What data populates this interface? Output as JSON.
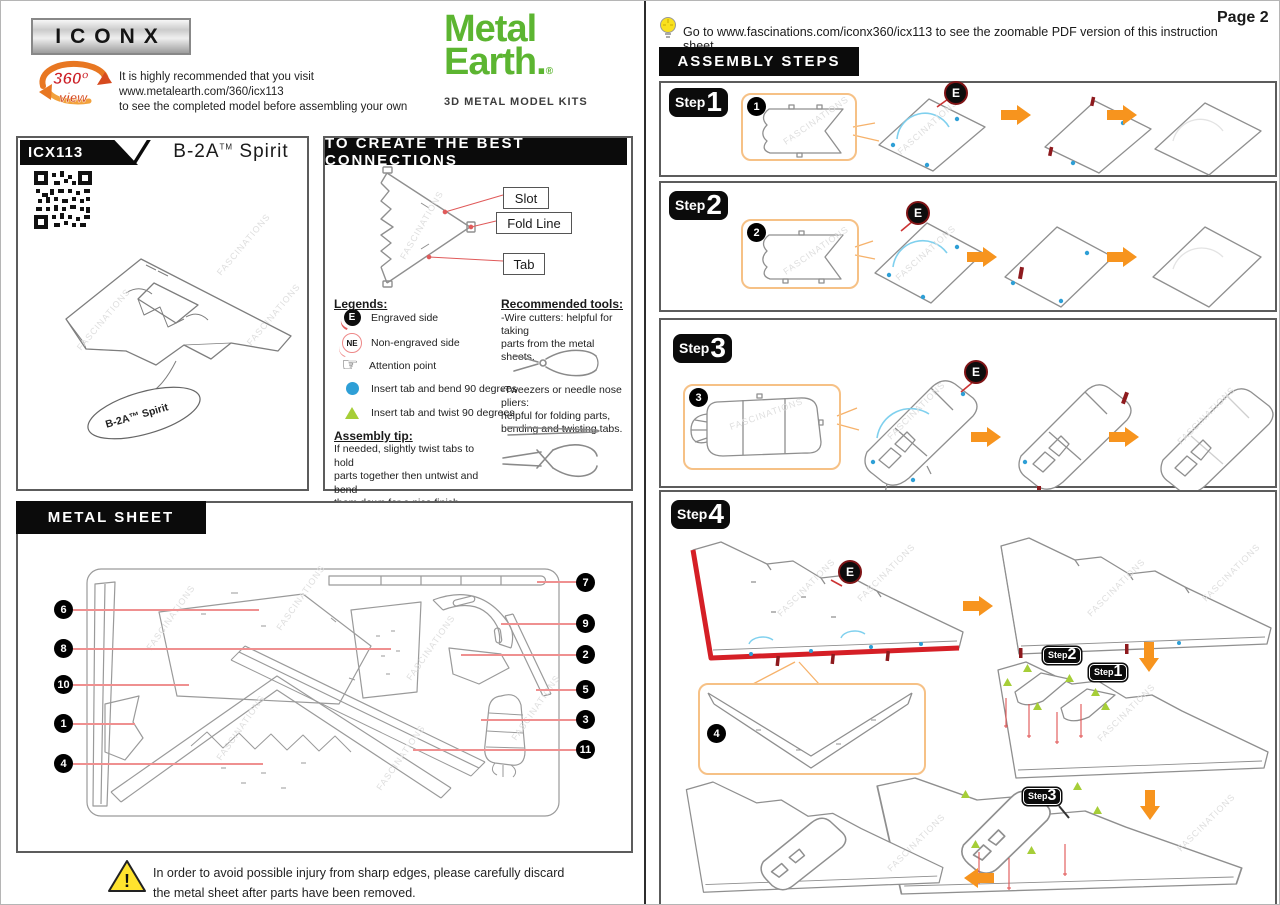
{
  "watermark": "FASCINATIONS",
  "page": {
    "label": "Page 2",
    "note": "Go to www.fascinations.com/iconx360/icx113  to see the zoomable PDF version of this instruction sheet"
  },
  "brand": {
    "logo": "ICONX",
    "metal": "Metal",
    "earth": "Earth.",
    "registered": "®",
    "tagline": "3D METAL MODEL KITS",
    "view360_number": "360º",
    "view360_word": "view",
    "recommend_line1": "It is highly recommended that you visit",
    "recommend_line2": "www.metalearth.com/360/icx113",
    "recommend_line3": "to see the completed model before assembling your own"
  },
  "model": {
    "sku": "ICX113",
    "name": "B-2A",
    "tm": "TM",
    "variant": "Spirit",
    "bubble": "B-2A™ Spirit"
  },
  "connections": {
    "title": "TO CREATE THE BEST CONNECTIONS",
    "slot": "Slot",
    "fold_line": "Fold Line",
    "tab": "Tab",
    "legends_title": "Legends:",
    "legend_e_symbol": "E",
    "legend_e": "Engraved side",
    "legend_ne_symbol": "NE",
    "legend_ne": "Non-engraved side",
    "legend_attention": "Attention point",
    "legend_bend": "Insert tab and bend 90 degrees",
    "legend_twist": "Insert tab and twist 90 degrees",
    "tip_title": "Assembly tip:",
    "tip_line1": "If needed, slightly twist tabs to hold",
    "tip_line2": "parts together then untwist and bend",
    "tip_line3": "them down for a nice finish",
    "tools_title": "Recommended tools:",
    "tool1_line1": "-Wire cutters: helpful for taking",
    "tool1_line2": "parts from the metal sheets.",
    "tool2_line1": "-Tweezers or needle nose pliers:",
    "tool2_line2": "helpful for folding parts,",
    "tool2_line3": "bending and twisting tabs."
  },
  "metal_sheet": {
    "title": "METAL SHEET",
    "callouts_left": [
      "6",
      "8",
      "10",
      "1",
      "4"
    ],
    "callouts_right": [
      "7",
      "9",
      "2",
      "5",
      "3",
      "11"
    ]
  },
  "warning": {
    "symbol": "!",
    "line1": "In order to avoid possible injury from sharp edges, please carefully discard",
    "line2": "the metal sheet after parts have been removed."
  },
  "assembly": {
    "title": "ASSEMBLY STEPS",
    "engraved": "E",
    "steps": [
      {
        "word": "Step",
        "num": "1",
        "part": "1"
      },
      {
        "word": "Step",
        "num": "2",
        "part": "2"
      },
      {
        "word": "Step",
        "num": "3",
        "part": "3"
      },
      {
        "word": "Step",
        "num": "4",
        "part": "4"
      }
    ],
    "mini": [
      {
        "word": "Step",
        "num": "2"
      },
      {
        "word": "Step",
        "num": "1"
      },
      {
        "word": "Step",
        "num": "3"
      }
    ]
  },
  "colors": {
    "brand_green": "#5CB531",
    "arrow_orange": "#F7941E",
    "highlight_red": "#D51F26",
    "fold_cyan": "#7FD0EE",
    "insert_blue": "#2E9FD6",
    "twist_green": "#A6CE38",
    "leader_pink": "#EF9090",
    "tab_dark_red": "#8E1A1E"
  }
}
